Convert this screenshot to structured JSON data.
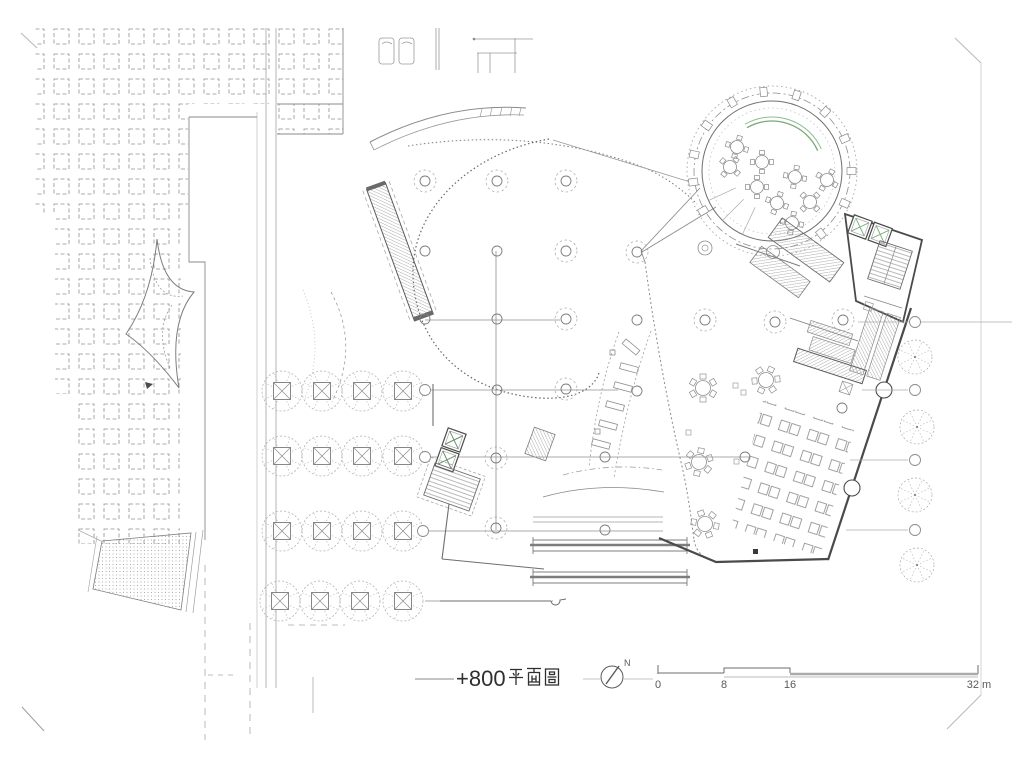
{
  "drawing": {
    "plan_label": {
      "text": "+800 平面圖",
      "numeric": "+800",
      "cjk": "平面圖"
    },
    "north_arrow": {
      "label": "N"
    },
    "scale_bar": {
      "unit": "m",
      "ticks": [
        "0",
        "8",
        "16",
        "32 m"
      ]
    },
    "colors": {
      "paper": "#ffffff",
      "wall_dark": "#4a4a4a",
      "line_medium": "#7d7d7d",
      "line_light": "#9e9e9e",
      "accent_green": "#7fae7f"
    },
    "features": [
      "paved-plaza-grid",
      "road",
      "tree-grid",
      "ramp-paving",
      "curved-canopy",
      "escalator-ramp",
      "column-grid",
      "c-shaped-wall",
      "elevator-core",
      "stairs",
      "benches",
      "circular-dining-pavilion",
      "green-curved-wall",
      "round-tables",
      "restaurant-building",
      "table-rows",
      "service-counter",
      "north-arrow",
      "scale-bar",
      "plan-title"
    ]
  }
}
